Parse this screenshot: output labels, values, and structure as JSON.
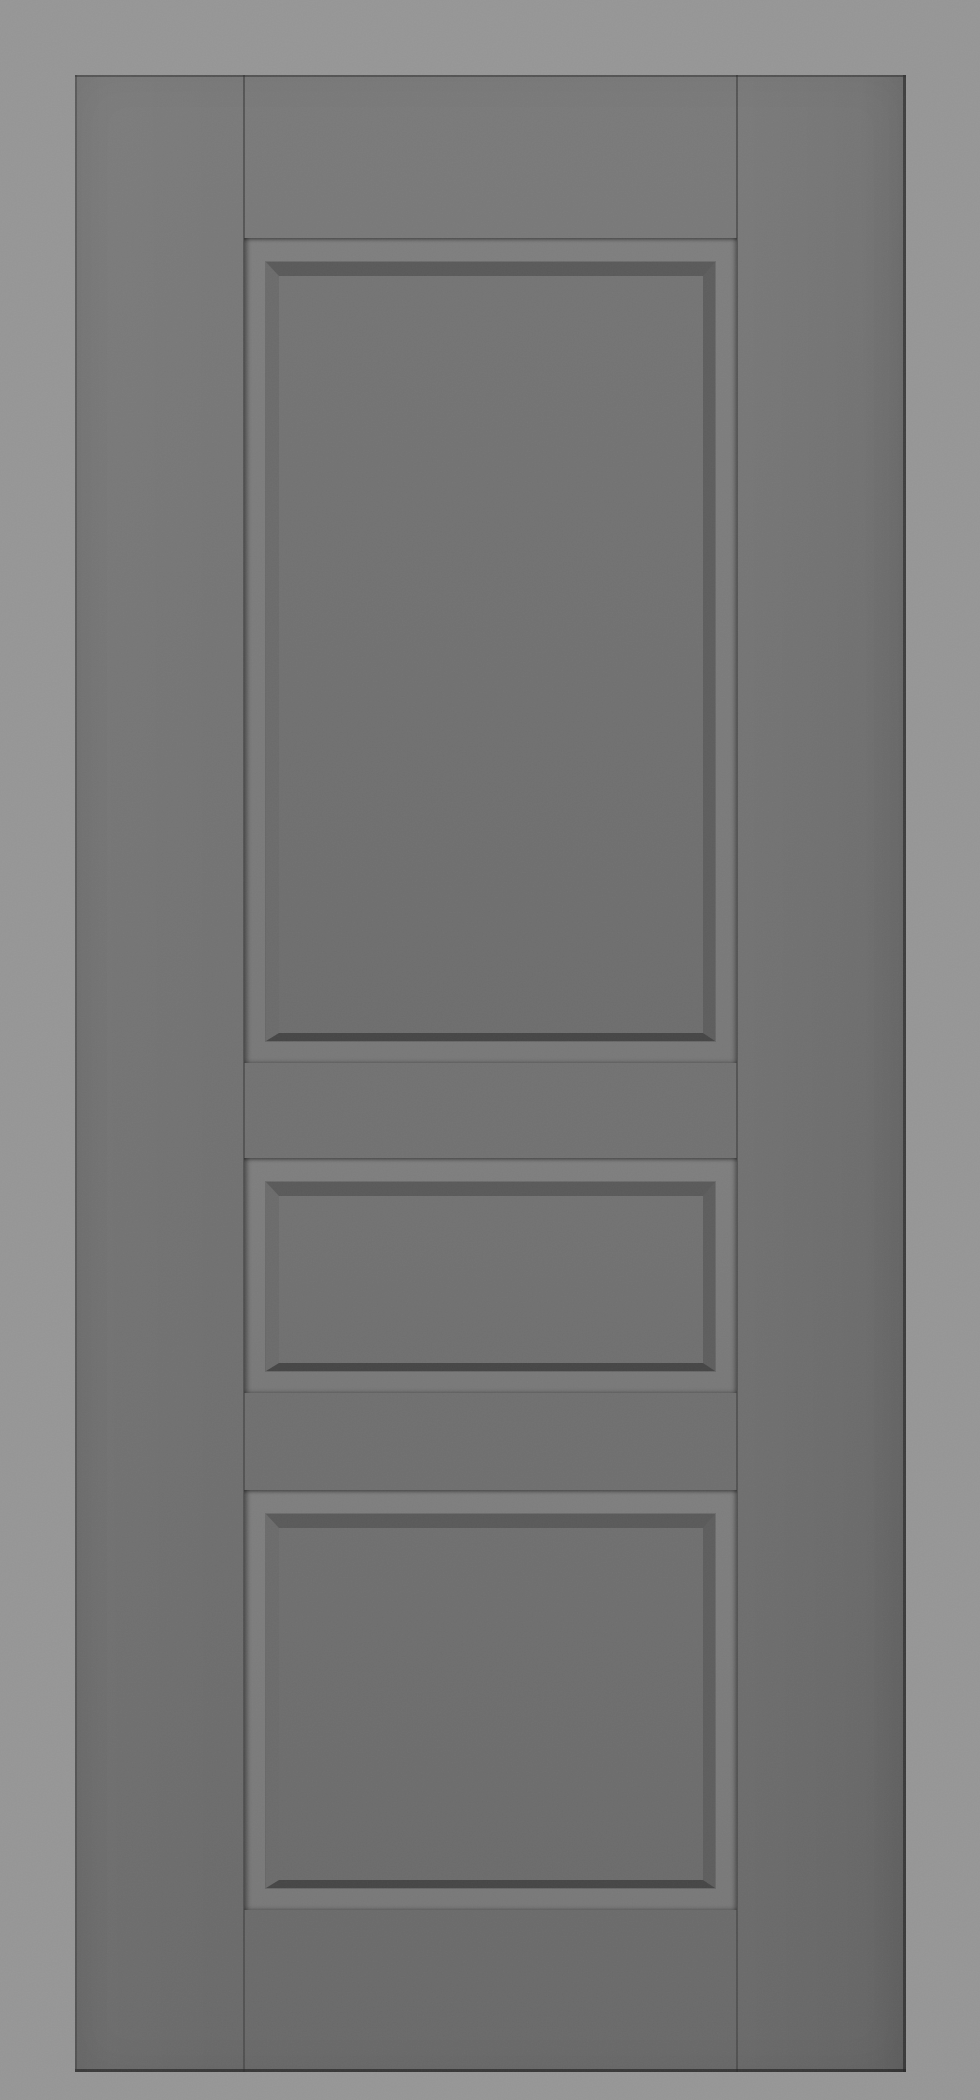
{
  "scene": {
    "description": "3D product render of a closed grey interior door slab with three raised panels, shown front-on against a plain light-grey backdrop",
    "object": "three-panel interior door",
    "finish": "matte grey paint, uniform colour, no handle or hardware",
    "construction": "flat stiles and rails with visible stile-rail joint seams; each panel sits in a recessed groove and has a bevelled raised centre",
    "panels": [
      {
        "position": "top",
        "shape": "tall rectangle"
      },
      {
        "position": "middle",
        "shape": "short wide rectangle"
      },
      {
        "position": "bottom",
        "shape": "medium rectangle"
      }
    ],
    "text_visible": ""
  },
  "palette": {
    "background": "#969696",
    "face_light": "#7a7a7a",
    "face_dark": "#696969",
    "groove_light": "#7e7e7e",
    "groove_dark": "#787878",
    "bevel_top": "#595959",
    "bevel_left": "#6b6b6b",
    "bevel_right": "#5d5d5d",
    "bevel_bottom": "#454545",
    "panel_face_light": "#747474",
    "panel_face_dark": "#6d6d6d",
    "edge_shadow": "#373737",
    "seam": "#5a5a5a"
  }
}
